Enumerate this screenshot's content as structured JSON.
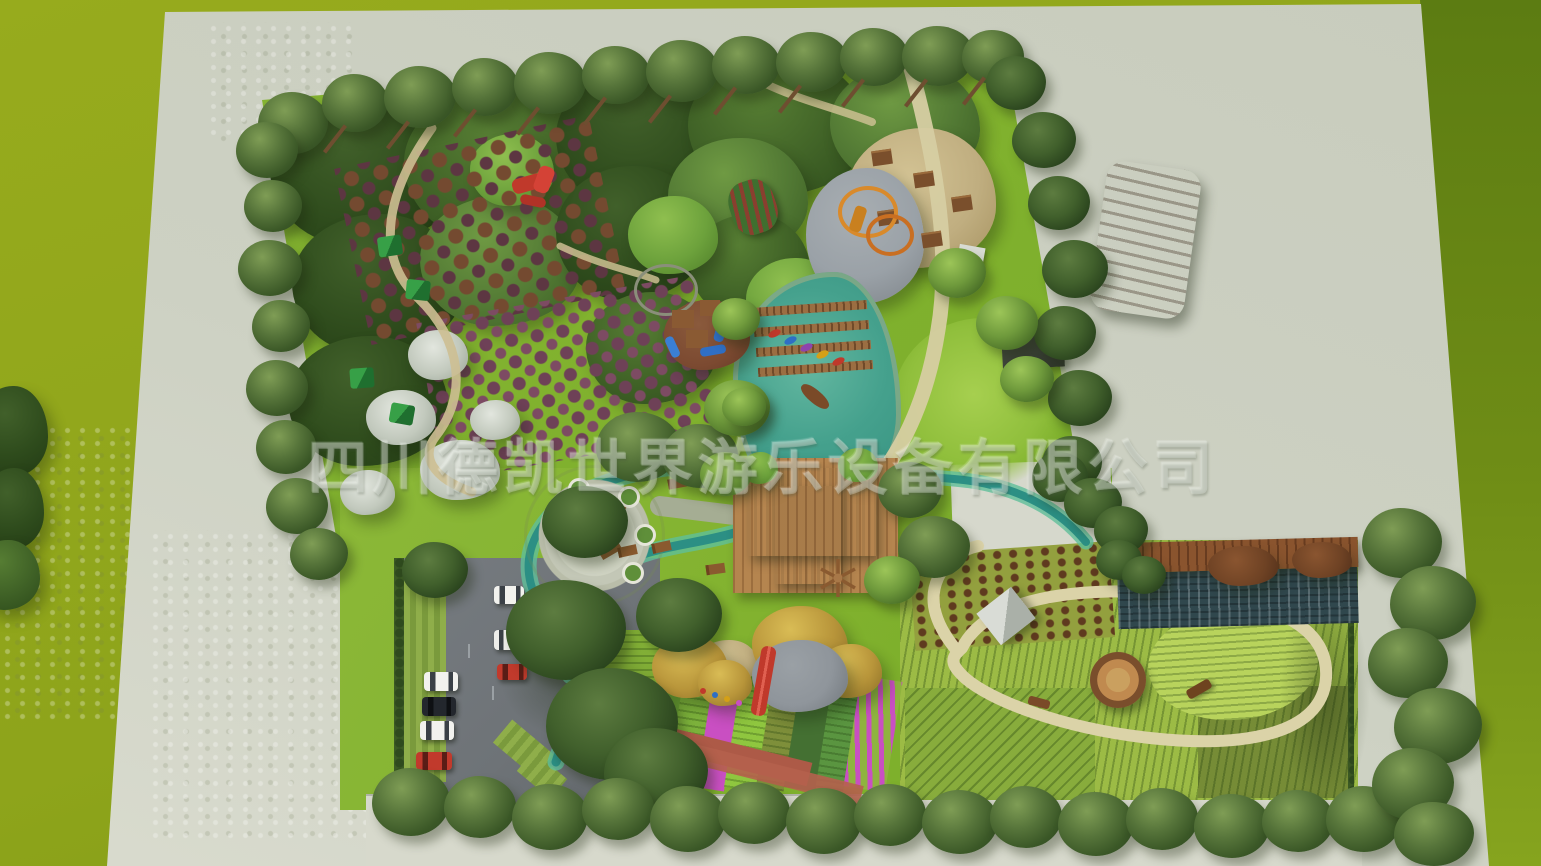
{
  "watermark": {
    "text": "四川德凯世界游乐设备有限公司"
  },
  "palette": {
    "bg_left": "#97ab1d",
    "bg_right_top": "#5c7c12",
    "bg_right_bottom": "#86a41e",
    "pad": "#c8ccbd",
    "pad_light": "#d9dbce",
    "lawn": "#7eb02c",
    "forest_dark": "#2e4b1c",
    "forest_mid": "#3f6126",
    "tree_olive": "#3b5827",
    "water": "#348f7e",
    "stream": "#2c8f84",
    "path_tan": "#d6cda2",
    "gravel": "#9aa1a7",
    "roof_gray": "#8b8b89",
    "deck_wood": "#b5854f",
    "bridge_wood": "#9b6e42",
    "asphalt": "#6e7377",
    "crop_green": "#9cbb45",
    "crop_light": "#b8d35c",
    "soil_brown": "#5f3a1f",
    "greenhouse_roof": "#8a542e",
    "panel_dark": "#30474d",
    "flower_magenta": "#c94fc2",
    "slide_red": "#c0392b",
    "blossom_white": "#c2c9bd",
    "orchard_purple": "#6e4157",
    "canopy_yellow": "#b8953a",
    "sidewalk": "#d7d9cc"
  }
}
